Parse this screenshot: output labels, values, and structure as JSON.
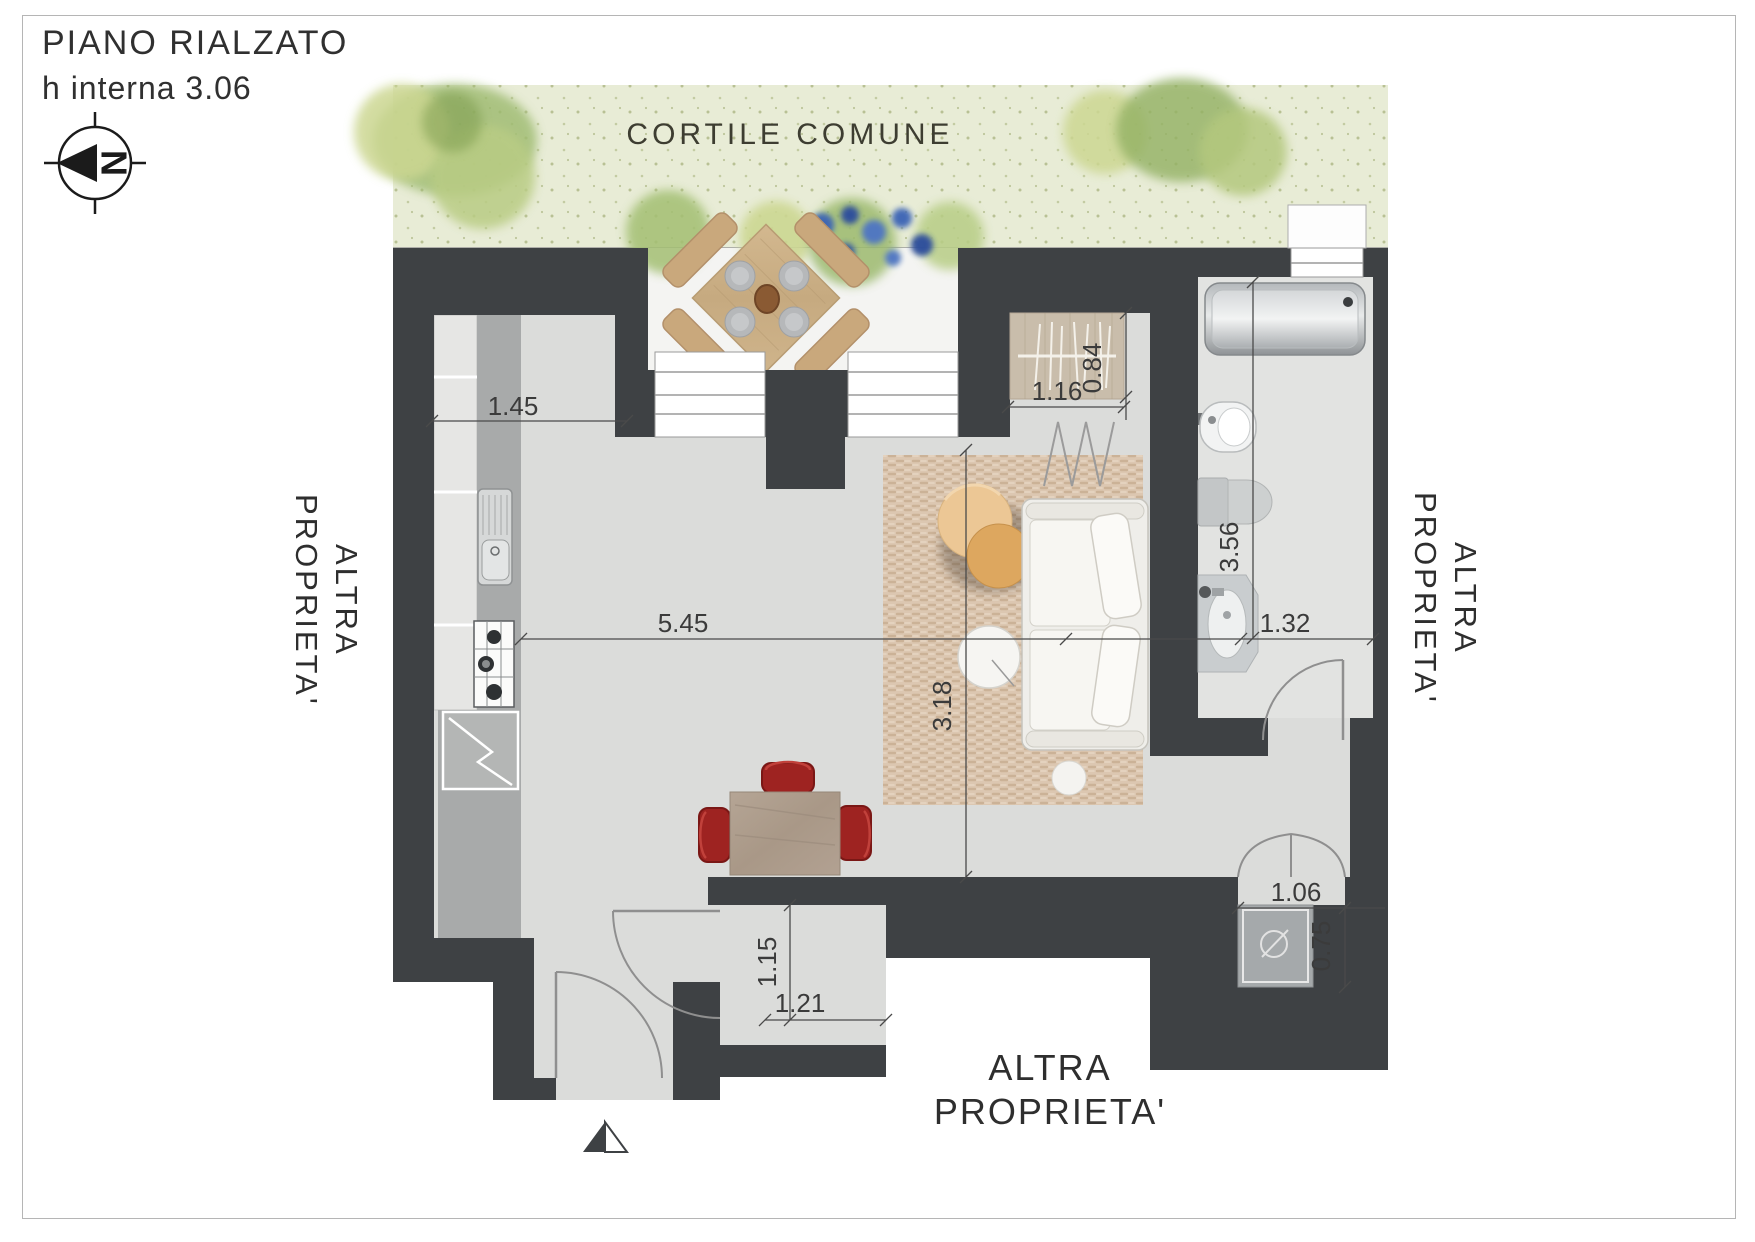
{
  "header": {
    "title": "PIANO RIALZATO",
    "subtitle": "h interna 3.06"
  },
  "compass": {
    "label": "N"
  },
  "areas": {
    "courtyard": "CORTILE COMUNE",
    "left_property_line1": "ALTRA",
    "left_property_line2": "PROPRIETA'",
    "right_property_line1": "ALTRA",
    "right_property_line2": "PROPRIETA'",
    "bottom_property_line1": "ALTRA",
    "bottom_property_line2": "PROPRIETA'"
  },
  "dimensions": {
    "kitchen_top": "1.45",
    "living_width": "5.45",
    "living_depth": "3.18",
    "wardrobe_width": "1.16",
    "wardrobe_depth": "0.84",
    "bathroom_length": "3.56",
    "bathroom_width": "1.32",
    "hallway_depth": "1.15",
    "hallway_width": "1.21",
    "shower_opening": "1.06",
    "shower_depth": "0.75"
  },
  "colors": {
    "wall": "#3e4144",
    "floor": "#dbdcda",
    "bath_floor": "#e2e3e1",
    "patio": "#f4f4f2",
    "courtyard": "#e8ecd6",
    "chair_red": "#9e2321",
    "rug": "#dcc7b1"
  }
}
